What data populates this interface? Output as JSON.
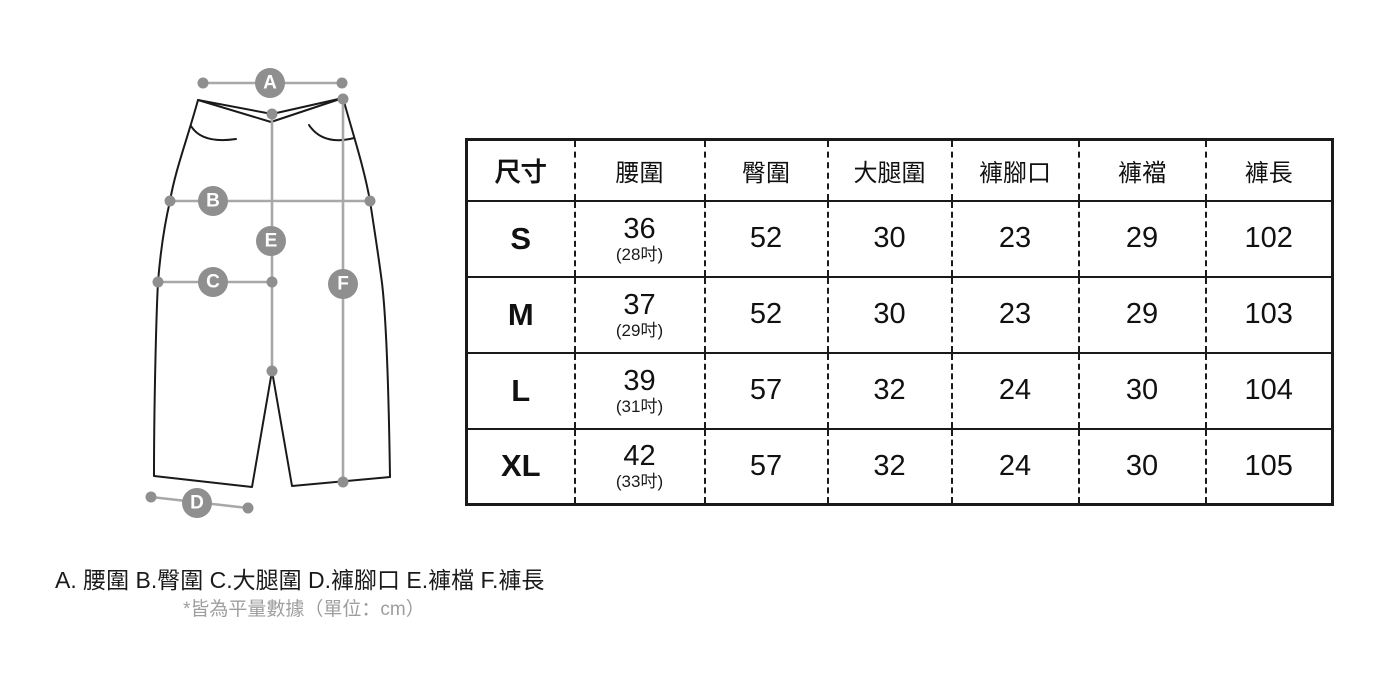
{
  "diagram": {
    "markers": [
      {
        "label": "A"
      },
      {
        "label": "B"
      },
      {
        "label": "C"
      },
      {
        "label": "D"
      },
      {
        "label": "E"
      },
      {
        "label": "F"
      }
    ]
  },
  "table": {
    "columns": [
      "尺寸",
      "腰圍",
      "臀圍",
      "大腿圍",
      "褲腳口",
      "褲襠",
      "褲長"
    ],
    "rows": [
      {
        "size": "S",
        "waist": "36",
        "waist_inch": "(28吋)",
        "hip": "52",
        "thigh": "30",
        "leg_opening": "23",
        "crotch": "29",
        "length": "102"
      },
      {
        "size": "M",
        "waist": "37",
        "waist_inch": "(29吋)",
        "hip": "52",
        "thigh": "30",
        "leg_opening": "23",
        "crotch": "29",
        "length": "103"
      },
      {
        "size": "L",
        "waist": "39",
        "waist_inch": "(31吋)",
        "hip": "57",
        "thigh": "32",
        "leg_opening": "24",
        "crotch": "30",
        "length": "104"
      },
      {
        "size": "XL",
        "waist": "42",
        "waist_inch": "(33吋)",
        "hip": "57",
        "thigh": "32",
        "leg_opening": "24",
        "crotch": "30",
        "length": "105"
      }
    ]
  },
  "legend": {
    "text": "A. 腰圍 B.臀圍 C.大腿圍 D.褲腳口 E.褲檔 F.褲長",
    "note": "*皆為平量數據（單位：cm）"
  },
  "colors": {
    "outline": "#1a1a1a",
    "measure_line": "#a8a8a8",
    "marker_fill": "#8f8f8f",
    "note_text": "#9e9e9e"
  }
}
